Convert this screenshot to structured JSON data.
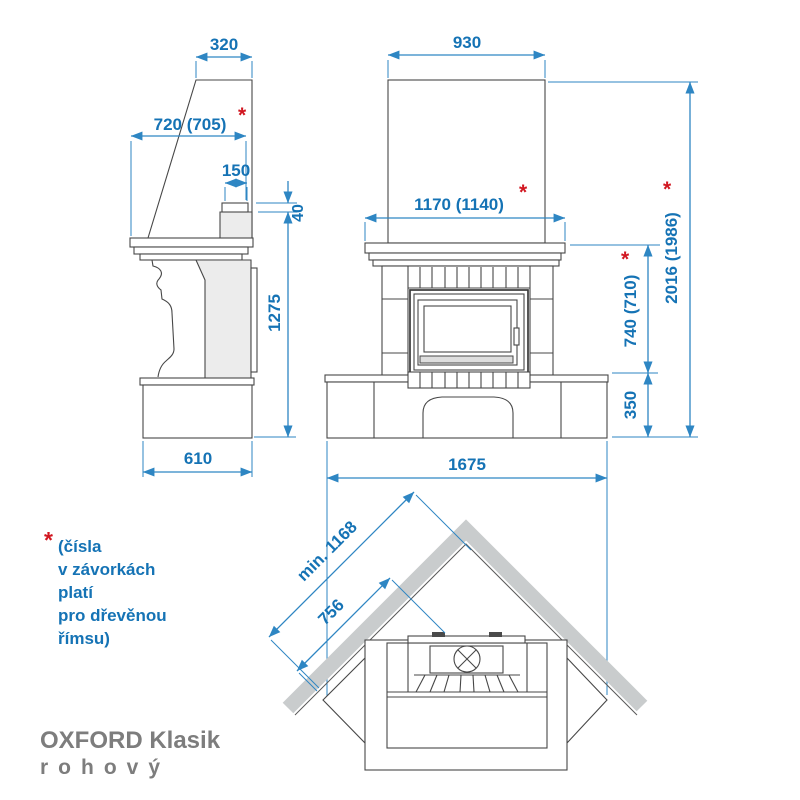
{
  "title": {
    "line1": "OXFORD Klasik",
    "line2": "rohový"
  },
  "note": {
    "asterisk": "*",
    "lines": [
      "(čísla",
      "v závorkách",
      "platí",
      "pro dřevěnou",
      "římsu)"
    ]
  },
  "side_view": {
    "dims": {
      "top_width": "320",
      "shelf_depth": "720 (705)",
      "collar_width": "150",
      "collar_height": "40",
      "body_height": "1275",
      "base_depth": "610"
    }
  },
  "front_view": {
    "dims": {
      "hood_width": "930",
      "shelf_width": "1170 (1140)",
      "firebox_zone_height": "740 (710)",
      "base_height": "350",
      "total_height": "2016 (1986)",
      "base_width": "1675"
    }
  },
  "top_view": {
    "dims": {
      "wall_min_length": "min. 1168",
      "wall_contact_length": "756"
    }
  },
  "colors": {
    "dimension_line_blue": "#2e86c3",
    "dimension_text_blue": "#1573b5",
    "asterisk_red": "#d11620",
    "outline_gray": "#474747",
    "wall_gray": "#c9cccd",
    "panel_gray": "#ececec",
    "title_gray": "#7d7d7d"
  }
}
